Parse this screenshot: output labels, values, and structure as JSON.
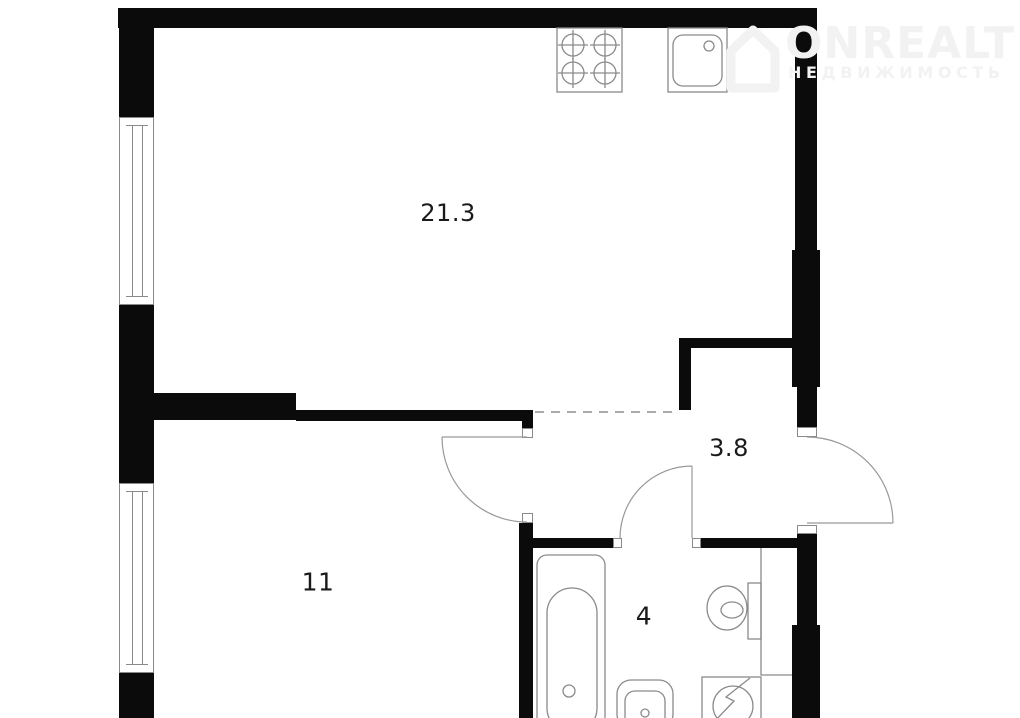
{
  "watermark": {
    "brand": "ONREALT",
    "subtitle": "НЕДВИЖИМОСТЬ",
    "logo_icon": "house-icon"
  },
  "plan": {
    "type": "apartment-floor-plan",
    "rooms": [
      {
        "id": "living-room-kitchen",
        "area_label": "21.3"
      },
      {
        "id": "bedroom",
        "area_label": "11"
      },
      {
        "id": "hallway",
        "area_label": "3.8"
      },
      {
        "id": "bathroom",
        "area_label": "4"
      }
    ],
    "fixtures": [
      "stove-icon",
      "kitchen-sink-icon",
      "bathtub-icon",
      "washbasin-icon",
      "toilet-icon",
      "washing-machine-icon",
      "window",
      "door-swing",
      "entrance-door-swing"
    ],
    "colors": {
      "wall": "#0b0b0b",
      "fixture_stroke": "#8a8a8a",
      "watermark": "#f2f2f2",
      "background": "#ffffff"
    }
  }
}
